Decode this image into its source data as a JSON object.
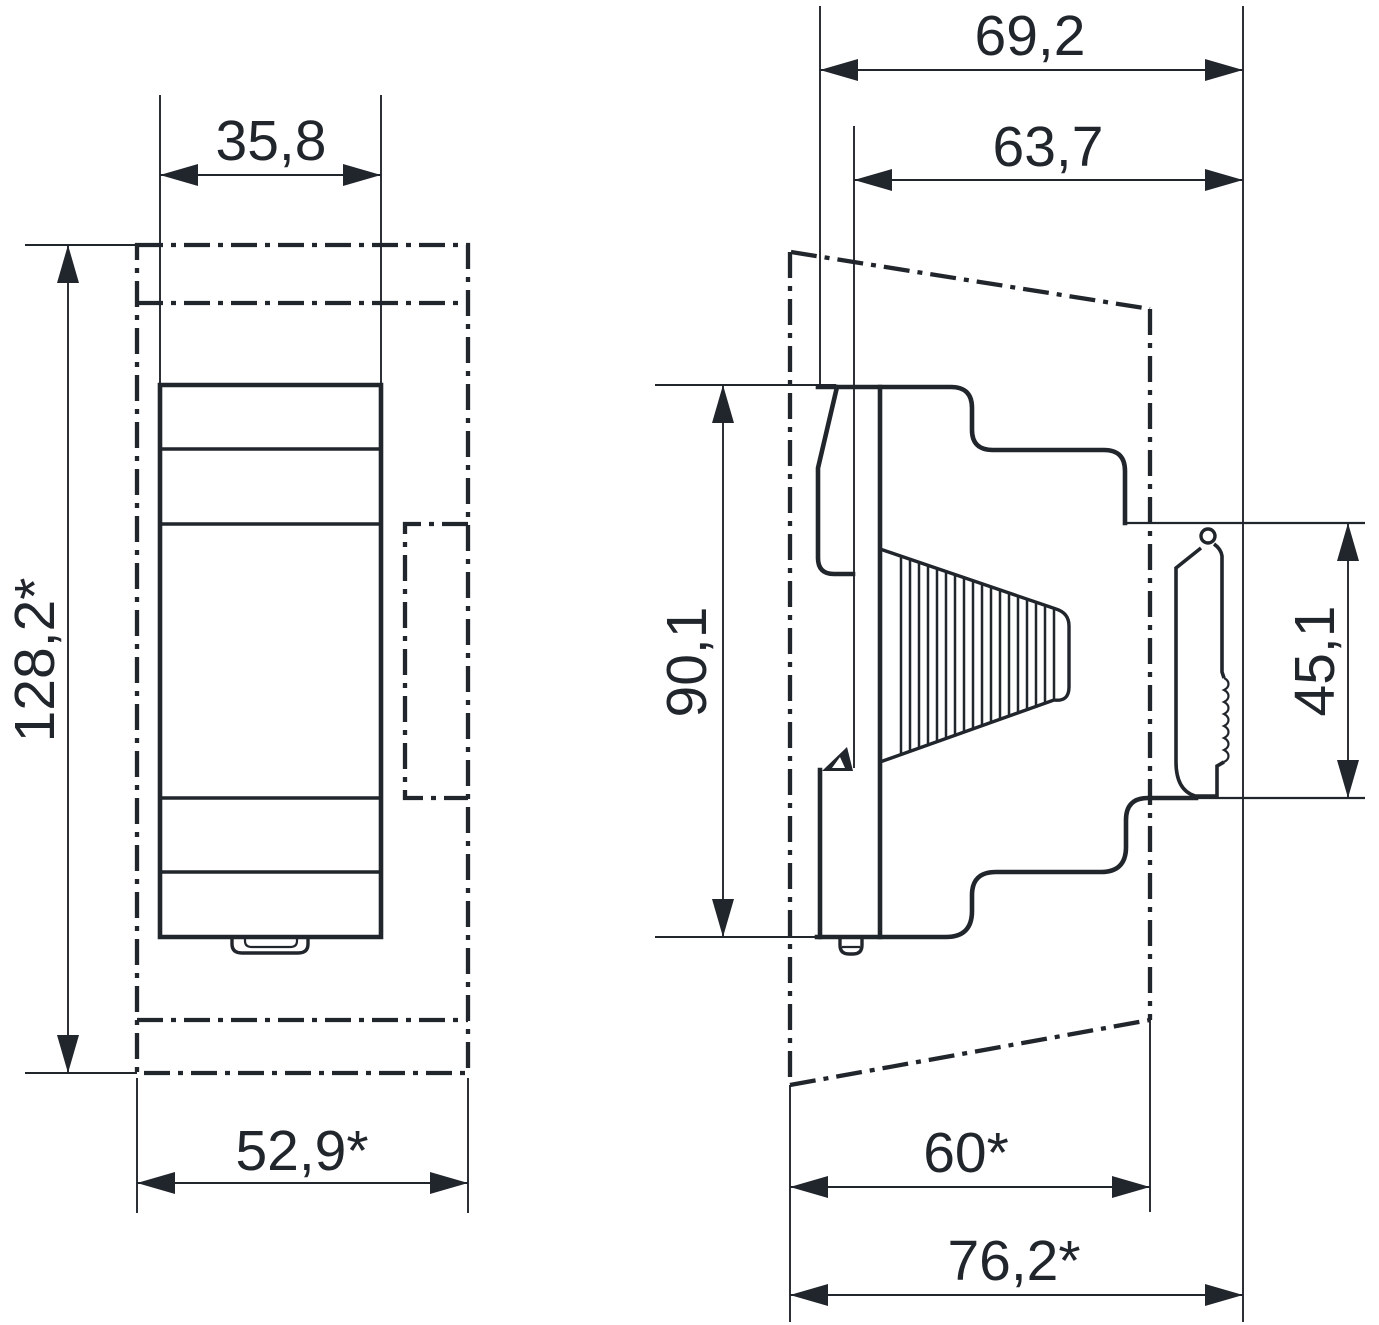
{
  "drawing": {
    "ink_color": "#21252c",
    "background_color": "#ffffff",
    "front_view": {
      "width_top": "35,8",
      "height_overall": "128,2*",
      "width_bottom": "52,9*"
    },
    "side_view": {
      "depth_overall": "69,2",
      "depth_body": "63,7",
      "height_body": "90,1",
      "height_rail_section": "45,1",
      "depth_lower": "60*",
      "depth_max": "76,2*"
    }
  }
}
